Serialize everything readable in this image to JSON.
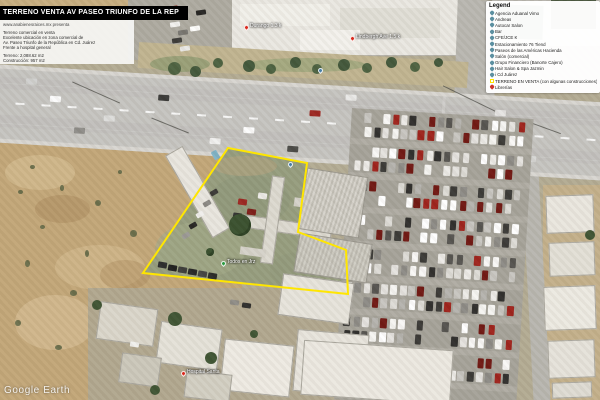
{
  "title_bar": {
    "text": "TERRENO VENTA AV PASEO TRIUNFO DE LA REP"
  },
  "info_panel": {
    "presenter": "www.anabienesraices.mx presenta",
    "lines": [
      "Terreno comercial en venta",
      "Excelente ubicación en zona comercial de",
      "Av. Paseo Triunfo de la República en Cd. Juárez",
      "Frente a hospital general"
    ],
    "stats": [
      "Terreno: 2,088.62 m2",
      "Construcción: 957 m2"
    ]
  },
  "legend": {
    "title": "Legend",
    "items": [
      {
        "label": "Agencia Aduanal Vimo",
        "icon": "pin",
        "color": "#5b8fa0"
      },
      {
        "label": "Andreas",
        "icon": "pin",
        "color": "#5b8fa0"
      },
      {
        "label": "Autocar Salon",
        "icon": "pin",
        "color": "#5b8fa0"
      },
      {
        "label": "Bar",
        "icon": "pin",
        "color": "#5b8fa0"
      },
      {
        "label": "CFE/JCE K",
        "icon": "pin",
        "color": "#5b8fa0"
      },
      {
        "label": "Estacionamiento 76 Tiend",
        "icon": "pin",
        "color": "#5b8fa0"
      },
      {
        "label": "Paseos de las Américas Hacienda",
        "icon": "pin",
        "color": "#5b8fa0"
      },
      {
        "label": "Salón (comercial)",
        "icon": "pin",
        "color": "#5b8fa0"
      },
      {
        "label": "Grupo Financiero (Banorte Cajero)",
        "icon": "pin",
        "color": "#5b8fa0"
      },
      {
        "label": "Hair Salon & Spa Jazmin",
        "icon": "pin",
        "color": "#5b8fa0"
      },
      {
        "label": "i Cd Juárez",
        "icon": "pin",
        "color": "#5b8fa0"
      },
      {
        "label": "TERRENO EN VENTA (con algunas construcciones)",
        "icon": "polygon",
        "color": "#ffe600"
      },
      {
        "label": "Librerías",
        "icon": "pin",
        "color": "#cc372b"
      }
    ]
  },
  "placemarks": [
    {
      "x": 244,
      "y": 25,
      "color": "#d92b1f",
      "text": "Durango 1.3 k"
    },
    {
      "x": 350,
      "y": 36,
      "color": "#d92b1f",
      "text": "Lindbergh Ave 1.5 k"
    },
    {
      "x": 221,
      "y": 261,
      "color": "#2e9b43",
      "text": "Todos en Jrz"
    },
    {
      "x": 181,
      "y": 371,
      "color": "#d92b1f",
      "text": "Hospital Santa"
    },
    {
      "x": 288,
      "y": 162,
      "color": "#4a7fa5",
      "text": ""
    },
    {
      "x": 318,
      "y": 68,
      "color": "#4a7fa5",
      "text": ""
    }
  ],
  "parcel": {
    "label": "TERRENO EN VENTA",
    "points": "228,148 307,163 298,232 346,250 348,294 143,273"
  },
  "watermark": {
    "text": "Google Earth"
  },
  "colors": {
    "parcel_outline": "#ffe600",
    "title_bar_bg": "#000000",
    "pin_red": "#d92b1f",
    "pin_green": "#2e9b43",
    "pin_teal": "#4a7fa5"
  }
}
